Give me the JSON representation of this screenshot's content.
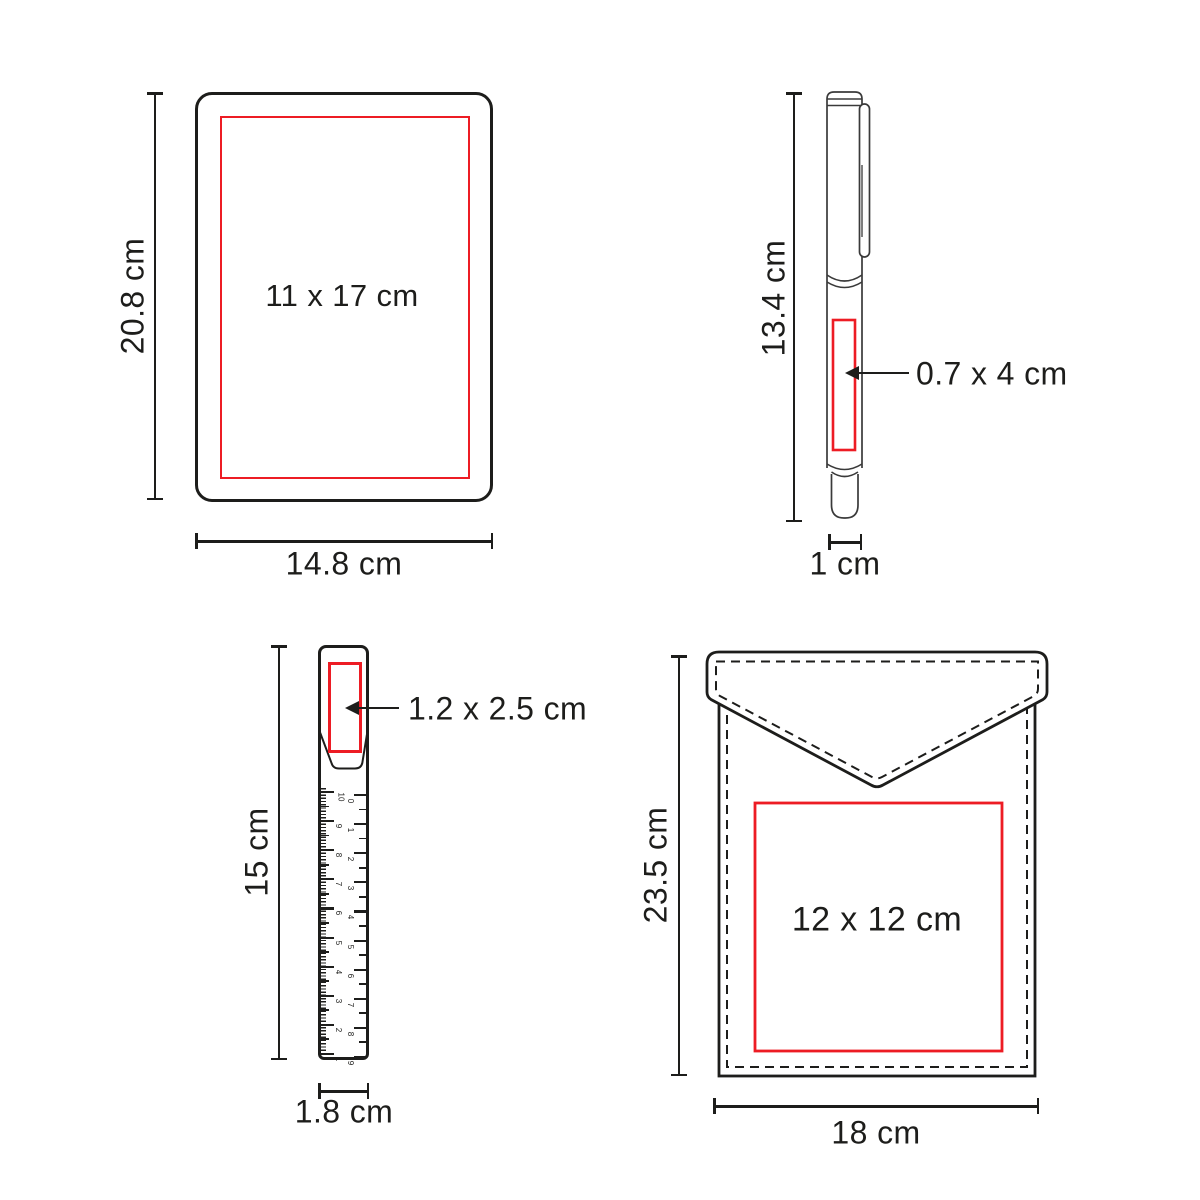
{
  "colors": {
    "line": "#1d1d1b",
    "accent_red": "#ed1c24"
  },
  "notebook": {
    "print_area_label": "11 x 17 cm",
    "height_label": "20.8 cm",
    "width_label": "14.8 cm"
  },
  "pen": {
    "print_area_label": "0.7 x 4 cm",
    "height_label": "13.4 cm",
    "width_label": "1 cm"
  },
  "ruler": {
    "print_area_label": "1.2 x 2.5 cm",
    "height_label": "15 cm",
    "width_label": "1.8 cm",
    "left_scale_numbers": [
      "10",
      "9",
      "8",
      "7",
      "6",
      "5",
      "4",
      "3",
      "2",
      "1"
    ],
    "right_scale_numbers": [
      "0",
      "1",
      "2",
      "3",
      "4",
      "5",
      "6",
      "7",
      "8",
      "9"
    ]
  },
  "pouch": {
    "print_area_label": "12 x 12 cm",
    "height_label": "23.5 cm",
    "width_label": "18 cm"
  }
}
